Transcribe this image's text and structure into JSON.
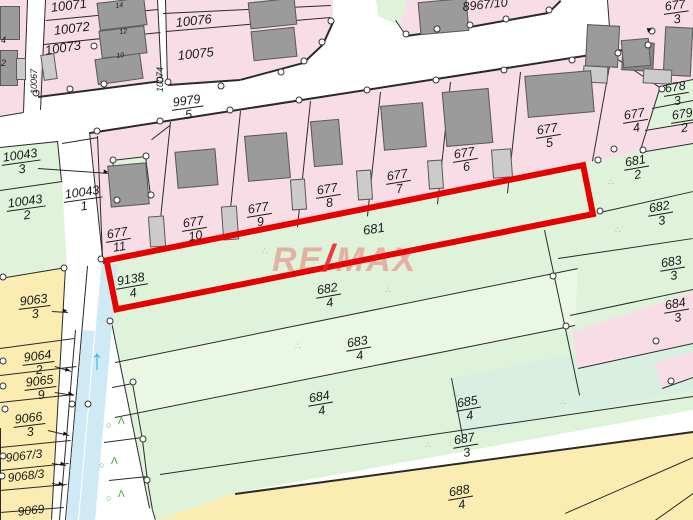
{
  "watermark": {
    "re": "RE",
    "slash": "/",
    "max": "MAX"
  },
  "symbols": {
    "vegetation_mark": "∴",
    "orchard_circle": "○",
    "orchard_caret": "Λ",
    "flow_arrow": "↑",
    "leader_arrowhead": "▸",
    "north_pointer": "►"
  },
  "colors": {
    "pink": "#f8dde7",
    "green": "#def3da",
    "green_light": "#eaf8e3",
    "mint": "#d9efe2",
    "yellow": "#fbecb2",
    "water": "#cfe9f5",
    "white": "#ffffff",
    "building": "#9b9b9b",
    "building_dark": "#868686",
    "building_light": "#cbcbcb",
    "line": "#2a2a2a",
    "highlight_red": "#e60000",
    "watermark_red": "#ed1c24",
    "label": "#1b1b1b",
    "veg_green": "#86c986",
    "orchard_green": "#3aa83a",
    "water_arrow": "#35c2de"
  },
  "labels": [
    {
      "id": "p10071",
      "t": "10071",
      "x": 50,
      "y": 1,
      "r": -7,
      "fs": 13
    },
    {
      "id": "p10072",
      "t": "10072",
      "x": 53,
      "y": 24,
      "r": -7,
      "fs": 13
    },
    {
      "id": "p10073",
      "t": "10073",
      "x": 44,
      "y": 44,
      "r": -9,
      "fs": 13
    },
    {
      "id": "p10076",
      "t": "10076",
      "x": 175,
      "y": 16,
      "r": -6,
      "fs": 13
    },
    {
      "id": "p10075",
      "t": "10075",
      "x": 177,
      "y": 49,
      "r": -6,
      "fs": 13
    },
    {
      "id": "hn14",
      "t": "14",
      "x": 115,
      "y": 3,
      "r": -7,
      "fs": 7
    },
    {
      "id": "hn12",
      "t": "12",
      "x": 119,
      "y": 29,
      "r": -7,
      "fs": 7
    },
    {
      "id": "hn10",
      "t": "10",
      "x": 116,
      "y": 53,
      "r": -7,
      "fs": 7
    },
    {
      "id": "edge4",
      "t": "4",
      "x": 1,
      "y": 36,
      "r": 0,
      "fs": 9
    },
    {
      "id": "edge2",
      "t": "2",
      "x": 1,
      "y": 59,
      "r": 0,
      "fs": 9
    },
    {
      "id": "v10067",
      "t": "10067",
      "x": 30,
      "y": 94,
      "r": -90,
      "fs": 9,
      "vert": true
    },
    {
      "id": "v10074",
      "t": "10074",
      "x": 156,
      "y": 92,
      "r": -87,
      "fs": 9,
      "vert": true
    },
    {
      "id": "p9979-5",
      "n": "9979",
      "d": "5",
      "x": 170,
      "y": 97,
      "r": -8
    },
    {
      "id": "p8967-10",
      "t": "8967/10",
      "x": 462,
      "y": 1,
      "r": -6,
      "fs": 12.5
    },
    {
      "id": "p677-3",
      "n": "677",
      "d": "3",
      "x": 662,
      "y": 1,
      "r": -8
    },
    {
      "id": "p678-3",
      "n": "678",
      "d": "3",
      "x": 662,
      "y": 83,
      "r": -9
    },
    {
      "id": "p679-2",
      "n": "679",
      "d": "2",
      "x": 669,
      "y": 110,
      "r": -9
    },
    {
      "id": "p677-4",
      "n": "677",
      "d": "4",
      "x": 621,
      "y": 110,
      "r": -9
    },
    {
      "id": "p677-5",
      "n": "677",
      "d": "5",
      "x": 534,
      "y": 125,
      "r": -9
    },
    {
      "id": "p677-6",
      "n": "677",
      "d": "6",
      "x": 451,
      "y": 149,
      "r": -9
    },
    {
      "id": "p677-7",
      "n": "677",
      "d": "7",
      "x": 384,
      "y": 171,
      "r": -9
    },
    {
      "id": "p677-8",
      "n": "677",
      "d": "8",
      "x": 314,
      "y": 185,
      "r": -9
    },
    {
      "id": "p677-9",
      "n": "677",
      "d": "9",
      "x": 245,
      "y": 204,
      "r": -9
    },
    {
      "id": "p677-10",
      "n": "677",
      "d": "10",
      "x": 180,
      "y": 218,
      "r": -9
    },
    {
      "id": "p677-11",
      "n": "677",
      "d": "11",
      "x": 104,
      "y": 229,
      "r": -9
    },
    {
      "id": "p10043-3",
      "n": "10043",
      "d": "3",
      "x": 0,
      "y": 152,
      "r": -8
    },
    {
      "id": "p10043-1",
      "n": "10043",
      "d": "1",
      "x": 62,
      "y": 189,
      "r": -8
    },
    {
      "id": "p10043-2",
      "n": "10043",
      "d": "2",
      "x": 5,
      "y": 198,
      "r": -8
    },
    {
      "id": "p681",
      "t": "681",
      "x": 362,
      "y": 224,
      "r": -9,
      "fs": 13
    },
    {
      "id": "p9138-4",
      "n": "9138",
      "d": "4",
      "x": 114,
      "y": 276,
      "r": -10
    },
    {
      "id": "p681-2",
      "n": "681",
      "d": "2",
      "x": 622,
      "y": 157,
      "r": -10
    },
    {
      "id": "p682-3",
      "n": "682",
      "d": "3",
      "x": 646,
      "y": 203,
      "r": -10
    },
    {
      "id": "p683-3",
      "n": "683",
      "d": "3",
      "x": 658,
      "y": 258,
      "r": -10
    },
    {
      "id": "p684-3",
      "n": "684",
      "d": "3",
      "x": 662,
      "y": 300,
      "r": -10
    },
    {
      "id": "p682-4",
      "n": "682",
      "d": "4",
      "x": 314,
      "y": 285,
      "r": -10
    },
    {
      "id": "p683-4",
      "n": "683",
      "d": "4",
      "x": 344,
      "y": 338,
      "r": -10
    },
    {
      "id": "p684-4",
      "n": "684",
      "d": "4",
      "x": 306,
      "y": 393,
      "r": -10
    },
    {
      "id": "p685-4",
      "n": "685",
      "d": "4",
      "x": 454,
      "y": 398,
      "r": -10
    },
    {
      "id": "p687-3",
      "n": "687",
      "d": "3",
      "x": 451,
      "y": 435,
      "r": -10
    },
    {
      "id": "p688-4",
      "n": "688",
      "d": "4",
      "x": 446,
      "y": 487,
      "r": -10
    },
    {
      "id": "p9063-3",
      "n": "9063",
      "d": "3",
      "x": 17,
      "y": 296,
      "r": -7
    },
    {
      "id": "p9064-2",
      "n": "9064",
      "d": "2",
      "x": 21,
      "y": 352,
      "r": -7
    },
    {
      "id": "p9065-9",
      "n": "9065",
      "d": "9",
      "x": 23,
      "y": 377,
      "r": -7
    },
    {
      "id": "p9066-3",
      "n": "9066",
      "d": "3",
      "x": 12,
      "y": 414,
      "r": -7
    },
    {
      "id": "p9067-3",
      "t": "9067/3",
      "x": 5,
      "y": 452,
      "r": -7,
      "fs": 12
    },
    {
      "id": "p9068-3",
      "t": "9068/3",
      "x": 7,
      "y": 472,
      "r": -7,
      "fs": 12
    },
    {
      "id": "p9069",
      "t": "9069",
      "x": 17,
      "y": 506,
      "r": -7,
      "fs": 12
    }
  ]
}
